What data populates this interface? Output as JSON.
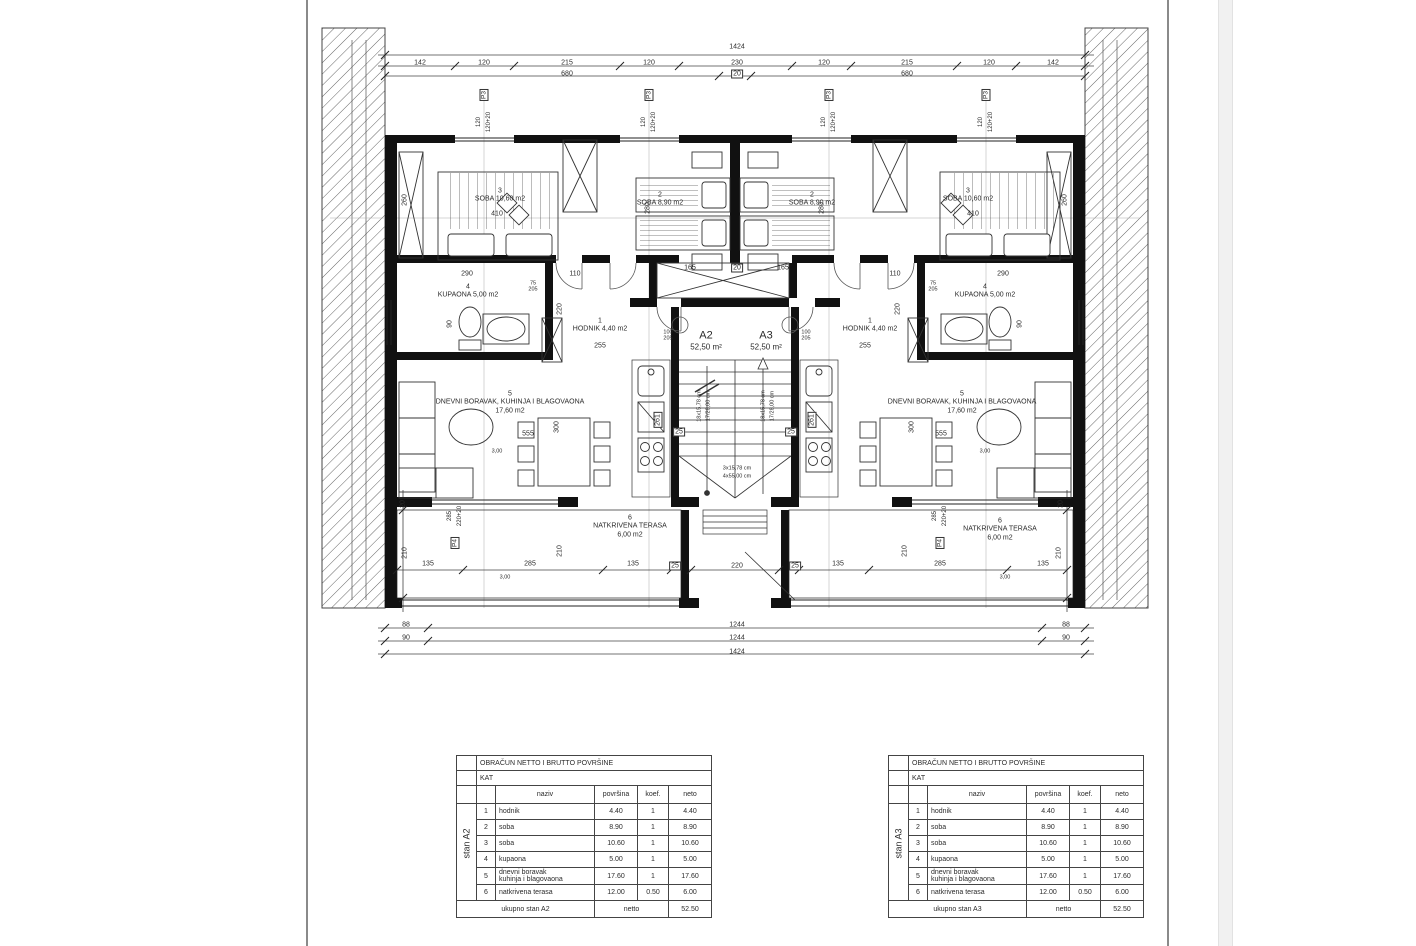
{
  "plan": {
    "dim_labels": [
      {
        "x": 737,
        "y": 47,
        "t": "1424"
      },
      {
        "x": 420,
        "y": 63,
        "t": "142"
      },
      {
        "x": 484,
        "y": 63,
        "t": "120"
      },
      {
        "x": 567,
        "y": 63,
        "t": "215"
      },
      {
        "x": 649,
        "y": 63,
        "t": "120"
      },
      {
        "x": 737,
        "y": 63,
        "t": "230"
      },
      {
        "x": 824,
        "y": 63,
        "t": "120"
      },
      {
        "x": 907,
        "y": 63,
        "t": "215"
      },
      {
        "x": 989,
        "y": 63,
        "t": "120"
      },
      {
        "x": 1053,
        "y": 63,
        "t": "142"
      },
      {
        "x": 567,
        "y": 74,
        "t": "680"
      },
      {
        "x": 737,
        "y": 74,
        "t": "20",
        "box": true
      },
      {
        "x": 907,
        "y": 74,
        "t": "680"
      },
      {
        "x": 497,
        "y": 214,
        "t": "410"
      },
      {
        "x": 973,
        "y": 214,
        "t": "410"
      },
      {
        "x": 405,
        "y": 200,
        "t": "260",
        "rot": true
      },
      {
        "x": 1065,
        "y": 200,
        "t": "260",
        "rot": true
      },
      {
        "x": 648,
        "y": 208,
        "t": "280",
        "rot": true
      },
      {
        "x": 822,
        "y": 208,
        "t": "280",
        "rot": true
      },
      {
        "x": 690,
        "y": 268,
        "t": "165"
      },
      {
        "x": 737,
        "y": 268,
        "t": "20",
        "box": true
      },
      {
        "x": 783,
        "y": 268,
        "t": "165"
      },
      {
        "x": 575,
        "y": 274,
        "t": "110"
      },
      {
        "x": 895,
        "y": 274,
        "t": "110"
      },
      {
        "x": 467,
        "y": 274,
        "t": "290"
      },
      {
        "x": 1003,
        "y": 274,
        "t": "290"
      },
      {
        "x": 533,
        "y": 287,
        "t": "75",
        "stack": "205"
      },
      {
        "x": 933,
        "y": 287,
        "t": "75",
        "stack": "205"
      },
      {
        "x": 668,
        "y": 336,
        "t": "100",
        "stack": "205"
      },
      {
        "x": 806,
        "y": 336,
        "t": "100",
        "stack": "205"
      },
      {
        "x": 560,
        "y": 309,
        "t": "220",
        "rot": true
      },
      {
        "x": 898,
        "y": 309,
        "t": "220",
        "rot": true
      },
      {
        "x": 600,
        "y": 346,
        "t": "255"
      },
      {
        "x": 865,
        "y": 346,
        "t": "255"
      },
      {
        "x": 450,
        "y": 324,
        "t": "90",
        "rot": true
      },
      {
        "x": 1020,
        "y": 324,
        "t": "90",
        "rot": true
      },
      {
        "x": 528,
        "y": 434,
        "t": "555"
      },
      {
        "x": 941,
        "y": 434,
        "t": "555"
      },
      {
        "x": 557,
        "y": 427,
        "t": "300",
        "rot": true
      },
      {
        "x": 912,
        "y": 427,
        "t": "300",
        "rot": true
      },
      {
        "x": 658,
        "y": 420,
        "t": "261",
        "rot": true,
        "box": true
      },
      {
        "x": 812,
        "y": 420,
        "t": "261",
        "rot": true,
        "box": true
      },
      {
        "x": 679,
        "y": 432,
        "t": "25",
        "box": true
      },
      {
        "x": 791,
        "y": 432,
        "t": "25",
        "box": true
      },
      {
        "x": 700,
        "y": 406,
        "t": "18x15,78 cm",
        "rot": true,
        "small": true
      },
      {
        "x": 709,
        "y": 406,
        "t": "17/28,00 cm",
        "rot": true,
        "small": true
      },
      {
        "x": 764,
        "y": 406,
        "t": "18x15,78 cm",
        "rot": true,
        "small": true
      },
      {
        "x": 773,
        "y": 406,
        "t": "17/28,00 cm",
        "rot": true,
        "small": true
      },
      {
        "x": 737,
        "y": 469,
        "t": "3x15,78 cm",
        "small": true
      },
      {
        "x": 737,
        "y": 477,
        "t": "4x55,00 cm",
        "small": true
      },
      {
        "x": 497,
        "y": 452,
        "t": "3,00",
        "small": true
      },
      {
        "x": 985,
        "y": 452,
        "t": "3,00",
        "small": true
      },
      {
        "x": 505,
        "y": 578,
        "t": "3,00",
        "small": true
      },
      {
        "x": 1005,
        "y": 578,
        "t": "3,00",
        "small": true
      },
      {
        "x": 405,
        "y": 553,
        "t": "210",
        "rot": true
      },
      {
        "x": 1059,
        "y": 553,
        "t": "210",
        "rot": true
      },
      {
        "x": 560,
        "y": 551,
        "t": "210",
        "rot": true
      },
      {
        "x": 905,
        "y": 551,
        "t": "210",
        "rot": true
      },
      {
        "x": 403,
        "y": 504,
        "t": "20",
        "rot": true
      },
      {
        "x": 1061,
        "y": 504,
        "t": "20",
        "rot": true
      },
      {
        "x": 428,
        "y": 564,
        "t": "135"
      },
      {
        "x": 530,
        "y": 564,
        "t": "285"
      },
      {
        "x": 633,
        "y": 564,
        "t": "135"
      },
      {
        "x": 675,
        "y": 566,
        "t": "25",
        "box": true
      },
      {
        "x": 737,
        "y": 566,
        "t": "220"
      },
      {
        "x": 795,
        "y": 566,
        "t": "25",
        "box": true
      },
      {
        "x": 838,
        "y": 564,
        "t": "135"
      },
      {
        "x": 940,
        "y": 564,
        "t": "285"
      },
      {
        "x": 1043,
        "y": 564,
        "t": "135"
      },
      {
        "x": 406,
        "y": 625,
        "t": "88"
      },
      {
        "x": 737,
        "y": 625,
        "t": "1244"
      },
      {
        "x": 1066,
        "y": 625,
        "t": "88"
      },
      {
        "x": 406,
        "y": 638,
        "t": "90"
      },
      {
        "x": 737,
        "y": 638,
        "t": "1244"
      },
      {
        "x": 1066,
        "y": 638,
        "t": "90"
      },
      {
        "x": 737,
        "y": 652,
        "t": "1424"
      }
    ],
    "room_labels": [
      {
        "x": 500,
        "y": 196,
        "lines": [
          "3",
          "SOBA 10,60 m2"
        ]
      },
      {
        "x": 968,
        "y": 196,
        "lines": [
          "3",
          "SOBA 10,60 m2"
        ]
      },
      {
        "x": 660,
        "y": 200,
        "lines": [
          "2",
          "SOBA 8,90 m2"
        ]
      },
      {
        "x": 812,
        "y": 200,
        "lines": [
          "2",
          "SOBA 8,90 m2"
        ]
      },
      {
        "x": 468,
        "y": 292,
        "lines": [
          "4",
          "KUPAONA 5,00 m2"
        ]
      },
      {
        "x": 985,
        "y": 292,
        "lines": [
          "4",
          "KUPAONA 5,00 m2"
        ]
      },
      {
        "x": 600,
        "y": 326,
        "lines": [
          "1",
          "HODNIK 4,40 m2"
        ]
      },
      {
        "x": 870,
        "y": 326,
        "lines": [
          "1",
          "HODNIK 4,40 m2"
        ]
      },
      {
        "x": 510,
        "y": 403,
        "lines": [
          "5",
          "DNEVNI BORAVAK, KUHINJA I BLAGOVAONA",
          "17,60 m2"
        ]
      },
      {
        "x": 962,
        "y": 403,
        "lines": [
          "5",
          "DNEVNI BORAVAK, KUHINJA I BLAGOVAONA",
          "17,60 m2"
        ]
      },
      {
        "x": 630,
        "y": 527,
        "lines": [
          "6",
          "NATKRIVENA TERASA",
          "6,00 m2"
        ]
      },
      {
        "x": 1000,
        "y": 530,
        "lines": [
          "6",
          "NATKRIVENA TERASA",
          "6,00 m2"
        ]
      },
      {
        "x": 706,
        "y": 341,
        "lines": [
          "A2",
          "52,50 m²"
        ],
        "big": true
      },
      {
        "x": 766,
        "y": 341,
        "lines": [
          "A3",
          "52,50 m²"
        ],
        "big": true
      }
    ],
    "window_tags": [
      {
        "x": 484,
        "y": 95,
        "t": "P3",
        "sub": "120|120+20",
        "sub_dy": 27
      },
      {
        "x": 649,
        "y": 95,
        "t": "P3",
        "sub": "120|120+20",
        "sub_dy": 27
      },
      {
        "x": 829,
        "y": 95,
        "t": "P3",
        "sub": "120|120+20",
        "sub_dy": 27
      },
      {
        "x": 986,
        "y": 95,
        "t": "P3",
        "sub": "120|120+20",
        "sub_dy": 27
      },
      {
        "x": 455,
        "y": 543,
        "t": "P4",
        "sub": "285|220+20",
        "sub_dy": -27
      },
      {
        "x": 940,
        "y": 543,
        "t": "P4",
        "sub": "285|220+20",
        "sub_dy": -27
      }
    ],
    "ticks": [
      [
        385,
        55
      ],
      [
        1085,
        55
      ],
      [
        385,
        66
      ],
      [
        455,
        66
      ],
      [
        514,
        66
      ],
      [
        620,
        66
      ],
      [
        679,
        66
      ],
      [
        792,
        66
      ],
      [
        851,
        66
      ],
      [
        957,
        66
      ],
      [
        1016,
        66
      ],
      [
        1085,
        66
      ],
      [
        385,
        76
      ],
      [
        719,
        76
      ],
      [
        751,
        76
      ],
      [
        1085,
        76
      ],
      [
        385,
        628
      ],
      [
        428,
        628
      ],
      [
        1042,
        628
      ],
      [
        1085,
        628
      ],
      [
        385,
        641
      ],
      [
        428,
        641
      ],
      [
        1042,
        641
      ],
      [
        1085,
        641
      ],
      [
        385,
        654
      ],
      [
        1085,
        654
      ],
      [
        397,
        570
      ],
      [
        463,
        570
      ],
      [
        603,
        570
      ],
      [
        671,
        570
      ],
      [
        691,
        570
      ],
      [
        779,
        570
      ],
      [
        799,
        570
      ],
      [
        869,
        570
      ],
      [
        1007,
        570
      ],
      [
        1067,
        570
      ],
      [
        403,
        510
      ],
      [
        403,
        598
      ],
      [
        1067,
        510
      ],
      [
        1067,
        598
      ]
    ]
  },
  "tables": [
    {
      "side_label": "stan A2",
      "title": "OBRAČUN NETTO I BRUTTO POVRŠINE",
      "floor": "KAT",
      "headers": {
        "naziv": "naziv",
        "povrsina": "površina",
        "koef": "koef.",
        "neto": "neto"
      },
      "rows": [
        [
          "1",
          "hodnik",
          "4.40",
          "1",
          "4.40"
        ],
        [
          "2",
          "soba",
          "8.90",
          "1",
          "8.90"
        ],
        [
          "3",
          "soba",
          "10.60",
          "1",
          "10.60"
        ],
        [
          "4",
          "kupaona",
          "5.00",
          "1",
          "5.00"
        ],
        [
          "5",
          "dnevni boravak\nkuhinja i blagovaona",
          "17.60",
          "1",
          "17.60"
        ],
        [
          "6",
          "natkrivena terasa",
          "12.00",
          "0.50",
          "6.00"
        ]
      ],
      "footer": [
        "ukupno stan A2",
        "netto",
        "52.50"
      ]
    },
    {
      "side_label": "stan A3",
      "title": "OBRAČUN NETTO I BRUTTO POVRŠINE",
      "floor": "KAT",
      "headers": {
        "naziv": "naziv",
        "povrsina": "površina",
        "koef": "koef.",
        "neto": "neto"
      },
      "rows": [
        [
          "1",
          "hodnik",
          "4.40",
          "1",
          "4.40"
        ],
        [
          "2",
          "soba",
          "8.90",
          "1",
          "8.90"
        ],
        [
          "3",
          "soba",
          "10.60",
          "1",
          "10.60"
        ],
        [
          "4",
          "kupaona",
          "5.00",
          "1",
          "5.00"
        ],
        [
          "5",
          "dnevni boravak\nkuhinja i blagovaona",
          "17.60",
          "1",
          "17.60"
        ],
        [
          "6",
          "natkrivena terasa",
          "12.00",
          "0.50",
          "6.00"
        ]
      ],
      "footer": [
        "ukupno stan A3",
        "netto",
        "52.50"
      ]
    }
  ]
}
